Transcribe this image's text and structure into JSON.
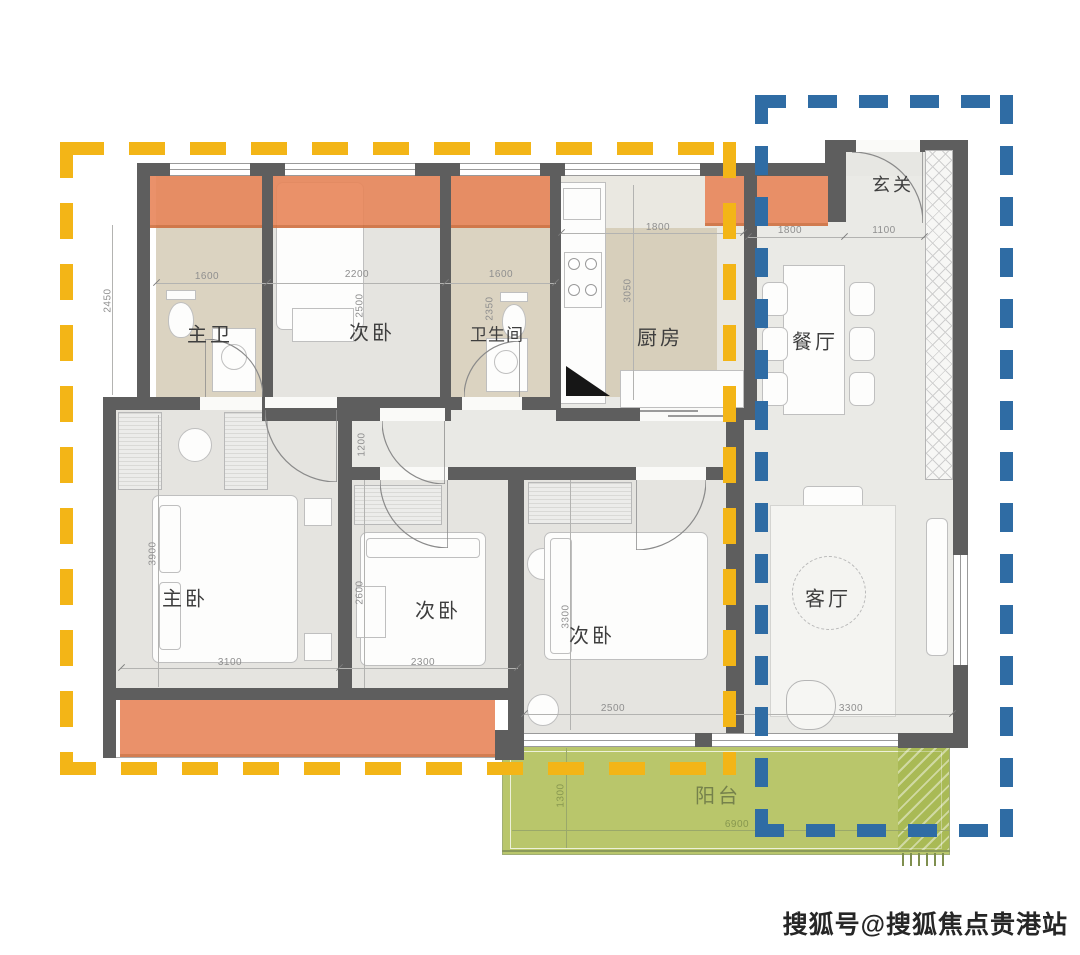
{
  "watermark": {
    "text": "搜狐号@搜狐焦点贵港站"
  },
  "rooms": {
    "master_bath": {
      "label": "主卫",
      "width_mm": "1600",
      "height_mm": "2450"
    },
    "bedroom_top": {
      "label": "次卧",
      "width_mm": "2200",
      "height_mm": "2500"
    },
    "bathroom": {
      "label": "卫生间",
      "width_mm": "1600",
      "height_mm": "2350"
    },
    "kitchen": {
      "label": "厨房",
      "width_mm": "1800",
      "height_mm": "3050"
    },
    "entry": {
      "label": "玄关",
      "width_mm_1": "1800",
      "width_mm_2": "1100"
    },
    "dining": {
      "label": "餐厅"
    },
    "living": {
      "label": "客厅",
      "width_mm": "3300"
    },
    "master_bedroom": {
      "label": "主卧",
      "width_mm": "3100",
      "height_mm": "3900"
    },
    "bedroom_mid": {
      "label": "次卧",
      "width_mm": "2300",
      "height_mm": "2600"
    },
    "bedroom_right": {
      "label": "次卧",
      "width_mm": "2500",
      "height_mm": "3300"
    },
    "balcony": {
      "label": "阳台",
      "depth_mm": "1300",
      "width_mm": "6900"
    },
    "hallway": {
      "width_mm": "1200"
    }
  },
  "colors": {
    "accent_orange": "#E8865A",
    "dash_yellow": "#F3B517",
    "dash_blue": "#2F6CA4",
    "balcony_green": "#B4C25F",
    "wall_gray": "#5E5E5E"
  }
}
